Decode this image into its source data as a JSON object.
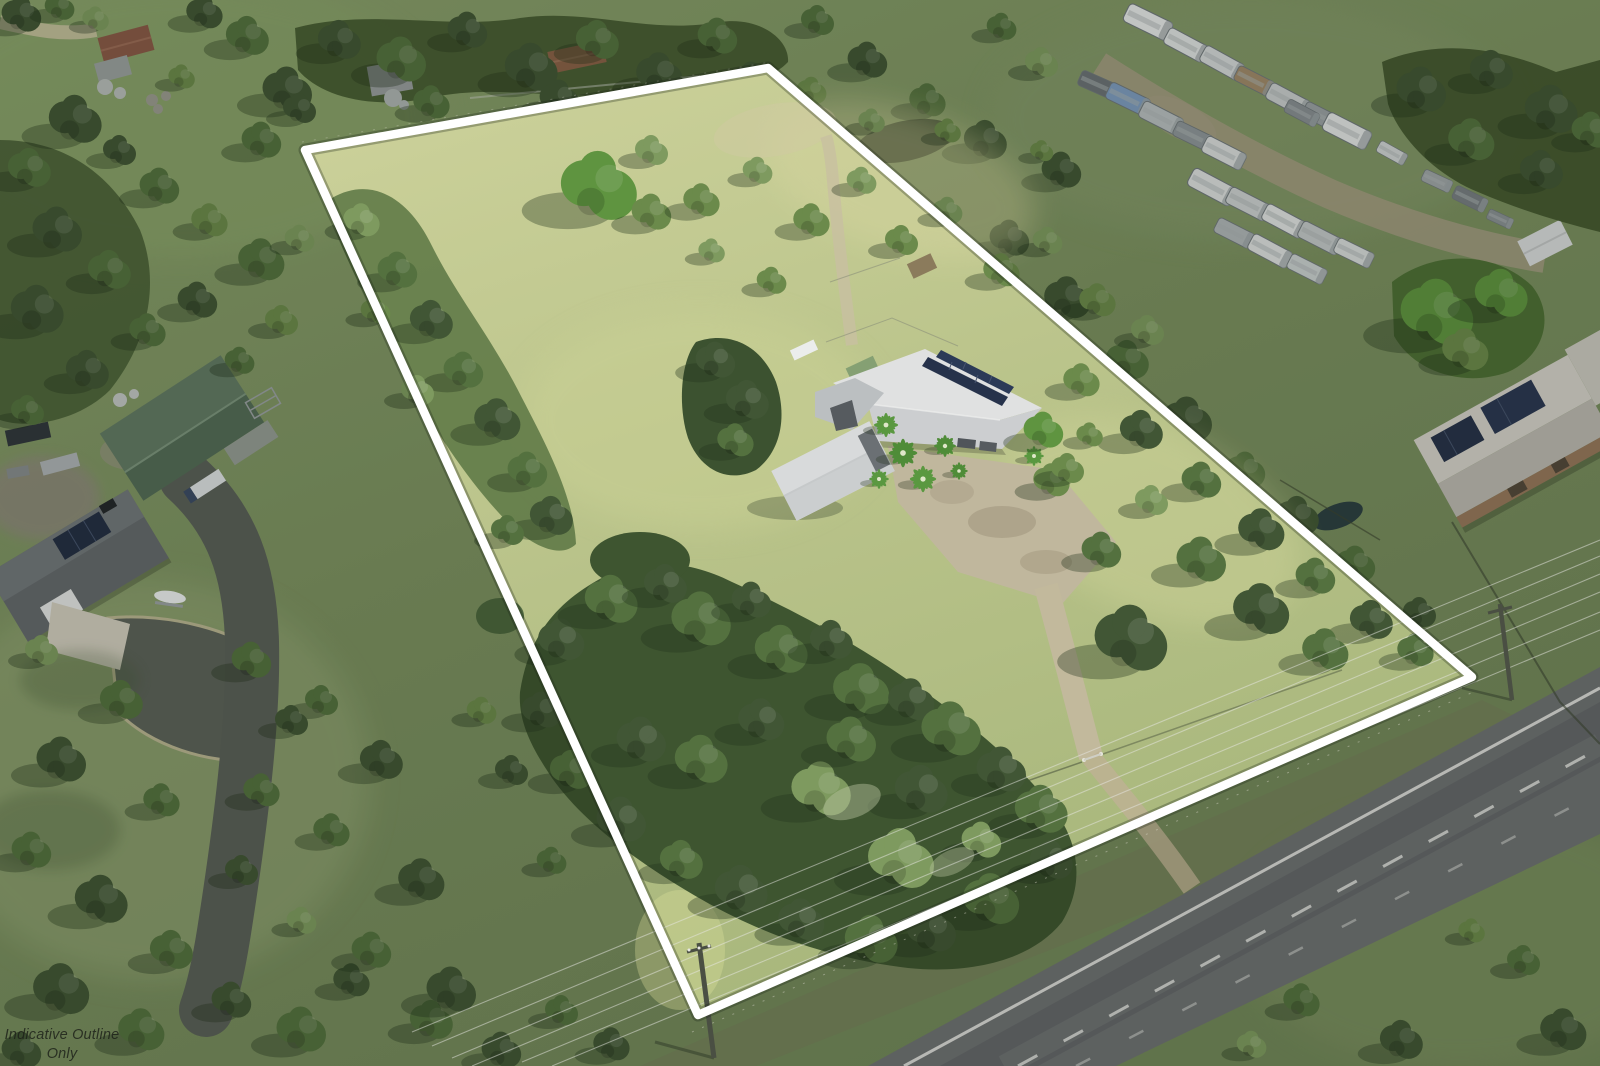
{
  "watermark": {
    "line1": "Indicative Outline",
    "line2": "Only"
  },
  "boundary": {
    "points": "305,150 768,68 1472,677 698,1015",
    "mask_path": "M0,0 H1600 V1066 H0 Z M305,150 L768,68 L1472,677 L698,1015 Z",
    "color": "#ffffff",
    "dim_color": "#0b0f08",
    "dim_opacity": "0.17"
  },
  "colors": {
    "road_marking": "#e6e6e3",
    "solar_panel": "#27324a",
    "asphalt": "#6e7173",
    "grass_inside": "#b8c289",
    "grass_outside": "#7c9161"
  }
}
